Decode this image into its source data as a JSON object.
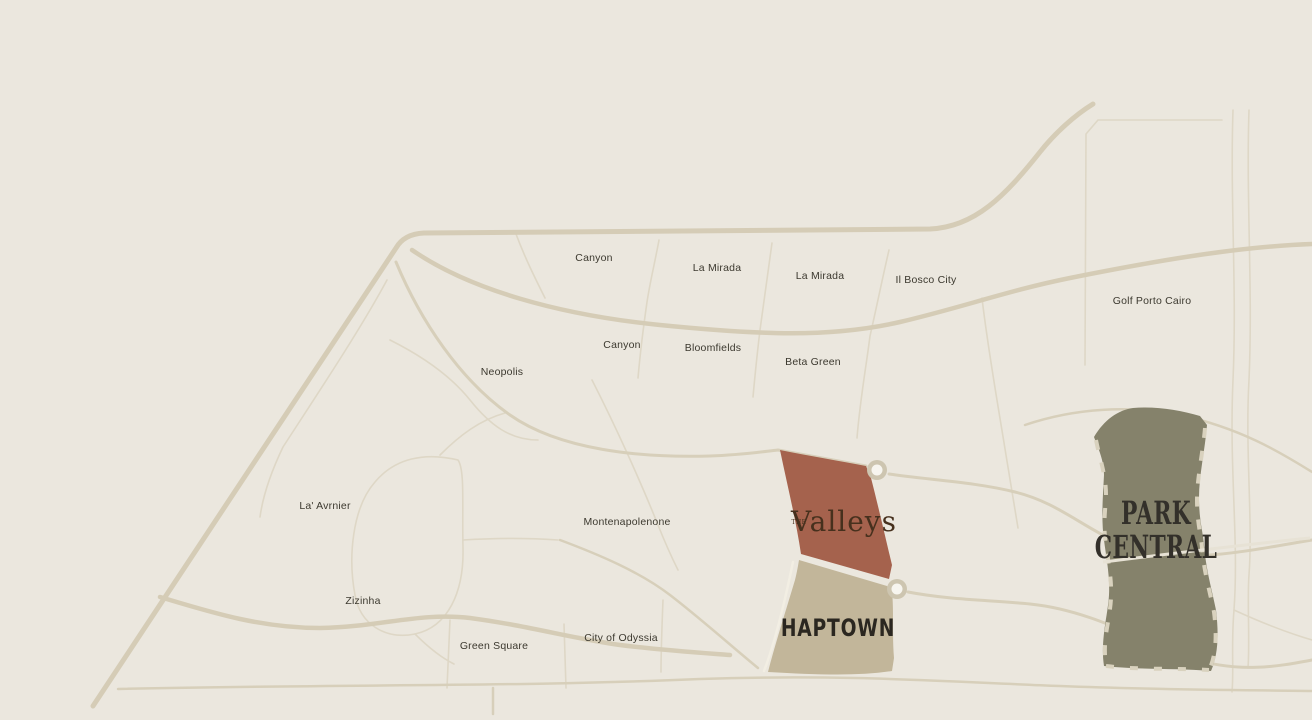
{
  "map": {
    "background_color": "#ebe7de",
    "road_color": "#d7cfba",
    "divider_color": "#ded7c6",
    "label_color": "#3c392f",
    "districts": [
      {
        "label": "Canyon"
      },
      {
        "label": "La Mirada"
      },
      {
        "label": "La Mirada"
      },
      {
        "label": "Il Bosco City"
      },
      {
        "label": "Golf Porto Cairo"
      },
      {
        "label": "Canyon"
      },
      {
        "label": "Bloomfields"
      },
      {
        "label": "Beta Green"
      },
      {
        "label": "Neopolis"
      },
      {
        "label": "La' Avrnier"
      },
      {
        "label": "Montenapolenone"
      },
      {
        "label": "Zizinha"
      },
      {
        "label": "Green Square"
      },
      {
        "label": "City of Odyssia"
      }
    ],
    "developments": {
      "valleys": {
        "prefix": "THE",
        "name": "Valleys",
        "fill": "#a5624d",
        "text_color": "#46301d"
      },
      "haptown": {
        "name": "HAPTOWN",
        "fill": "#c2b69a",
        "text_color": "#2b2720"
      },
      "park_central": {
        "line1": "PARK",
        "line2": "CENTRAL",
        "fill": "#85826b",
        "text_color": "#33302a"
      }
    }
  }
}
